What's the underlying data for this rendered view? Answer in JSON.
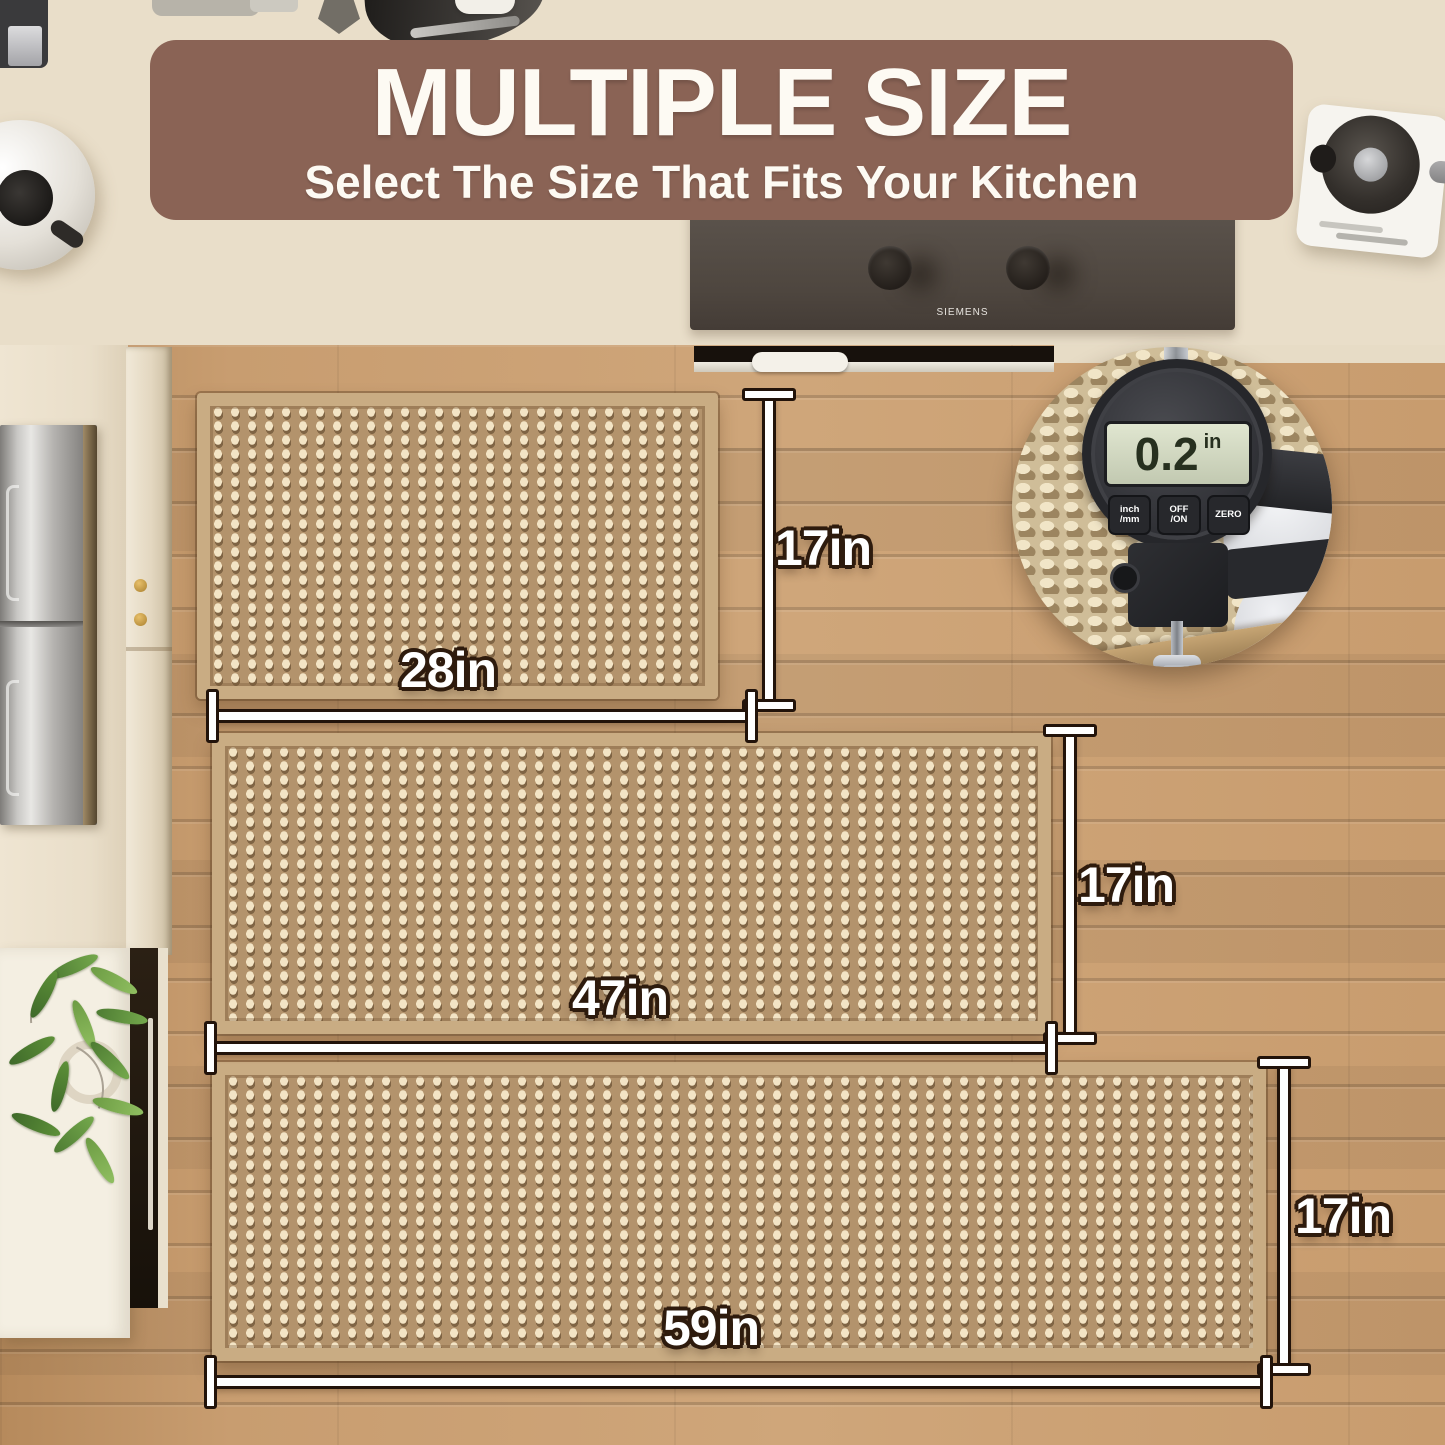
{
  "banner": {
    "title": "MULTIPLE SIZE",
    "subtitle": "Select The Size That Fits Your Kitchen",
    "bg_color": "#8a6355",
    "text_color": "#fdfaf3"
  },
  "cooktop": {
    "brand": "SIEMENS"
  },
  "inset": {
    "gauge_reading": "0.2",
    "gauge_unit": "in",
    "buttons": [
      "inch\n/mm",
      "OFF\n/ON",
      "ZERO"
    ]
  },
  "sizes": {
    "small": {
      "width_label": "28in",
      "height_label": "17in"
    },
    "medium": {
      "width_label": "47in",
      "height_label": "17in"
    },
    "large": {
      "width_label": "59in",
      "height_label": "17in"
    }
  },
  "colors": {
    "rug_base": "#b3936c",
    "rug_dot": "#f3e4c5",
    "wood_floor": "#c79c6f",
    "dimension_outline": "#22130a",
    "label_outline": "#2e1b0d"
  }
}
